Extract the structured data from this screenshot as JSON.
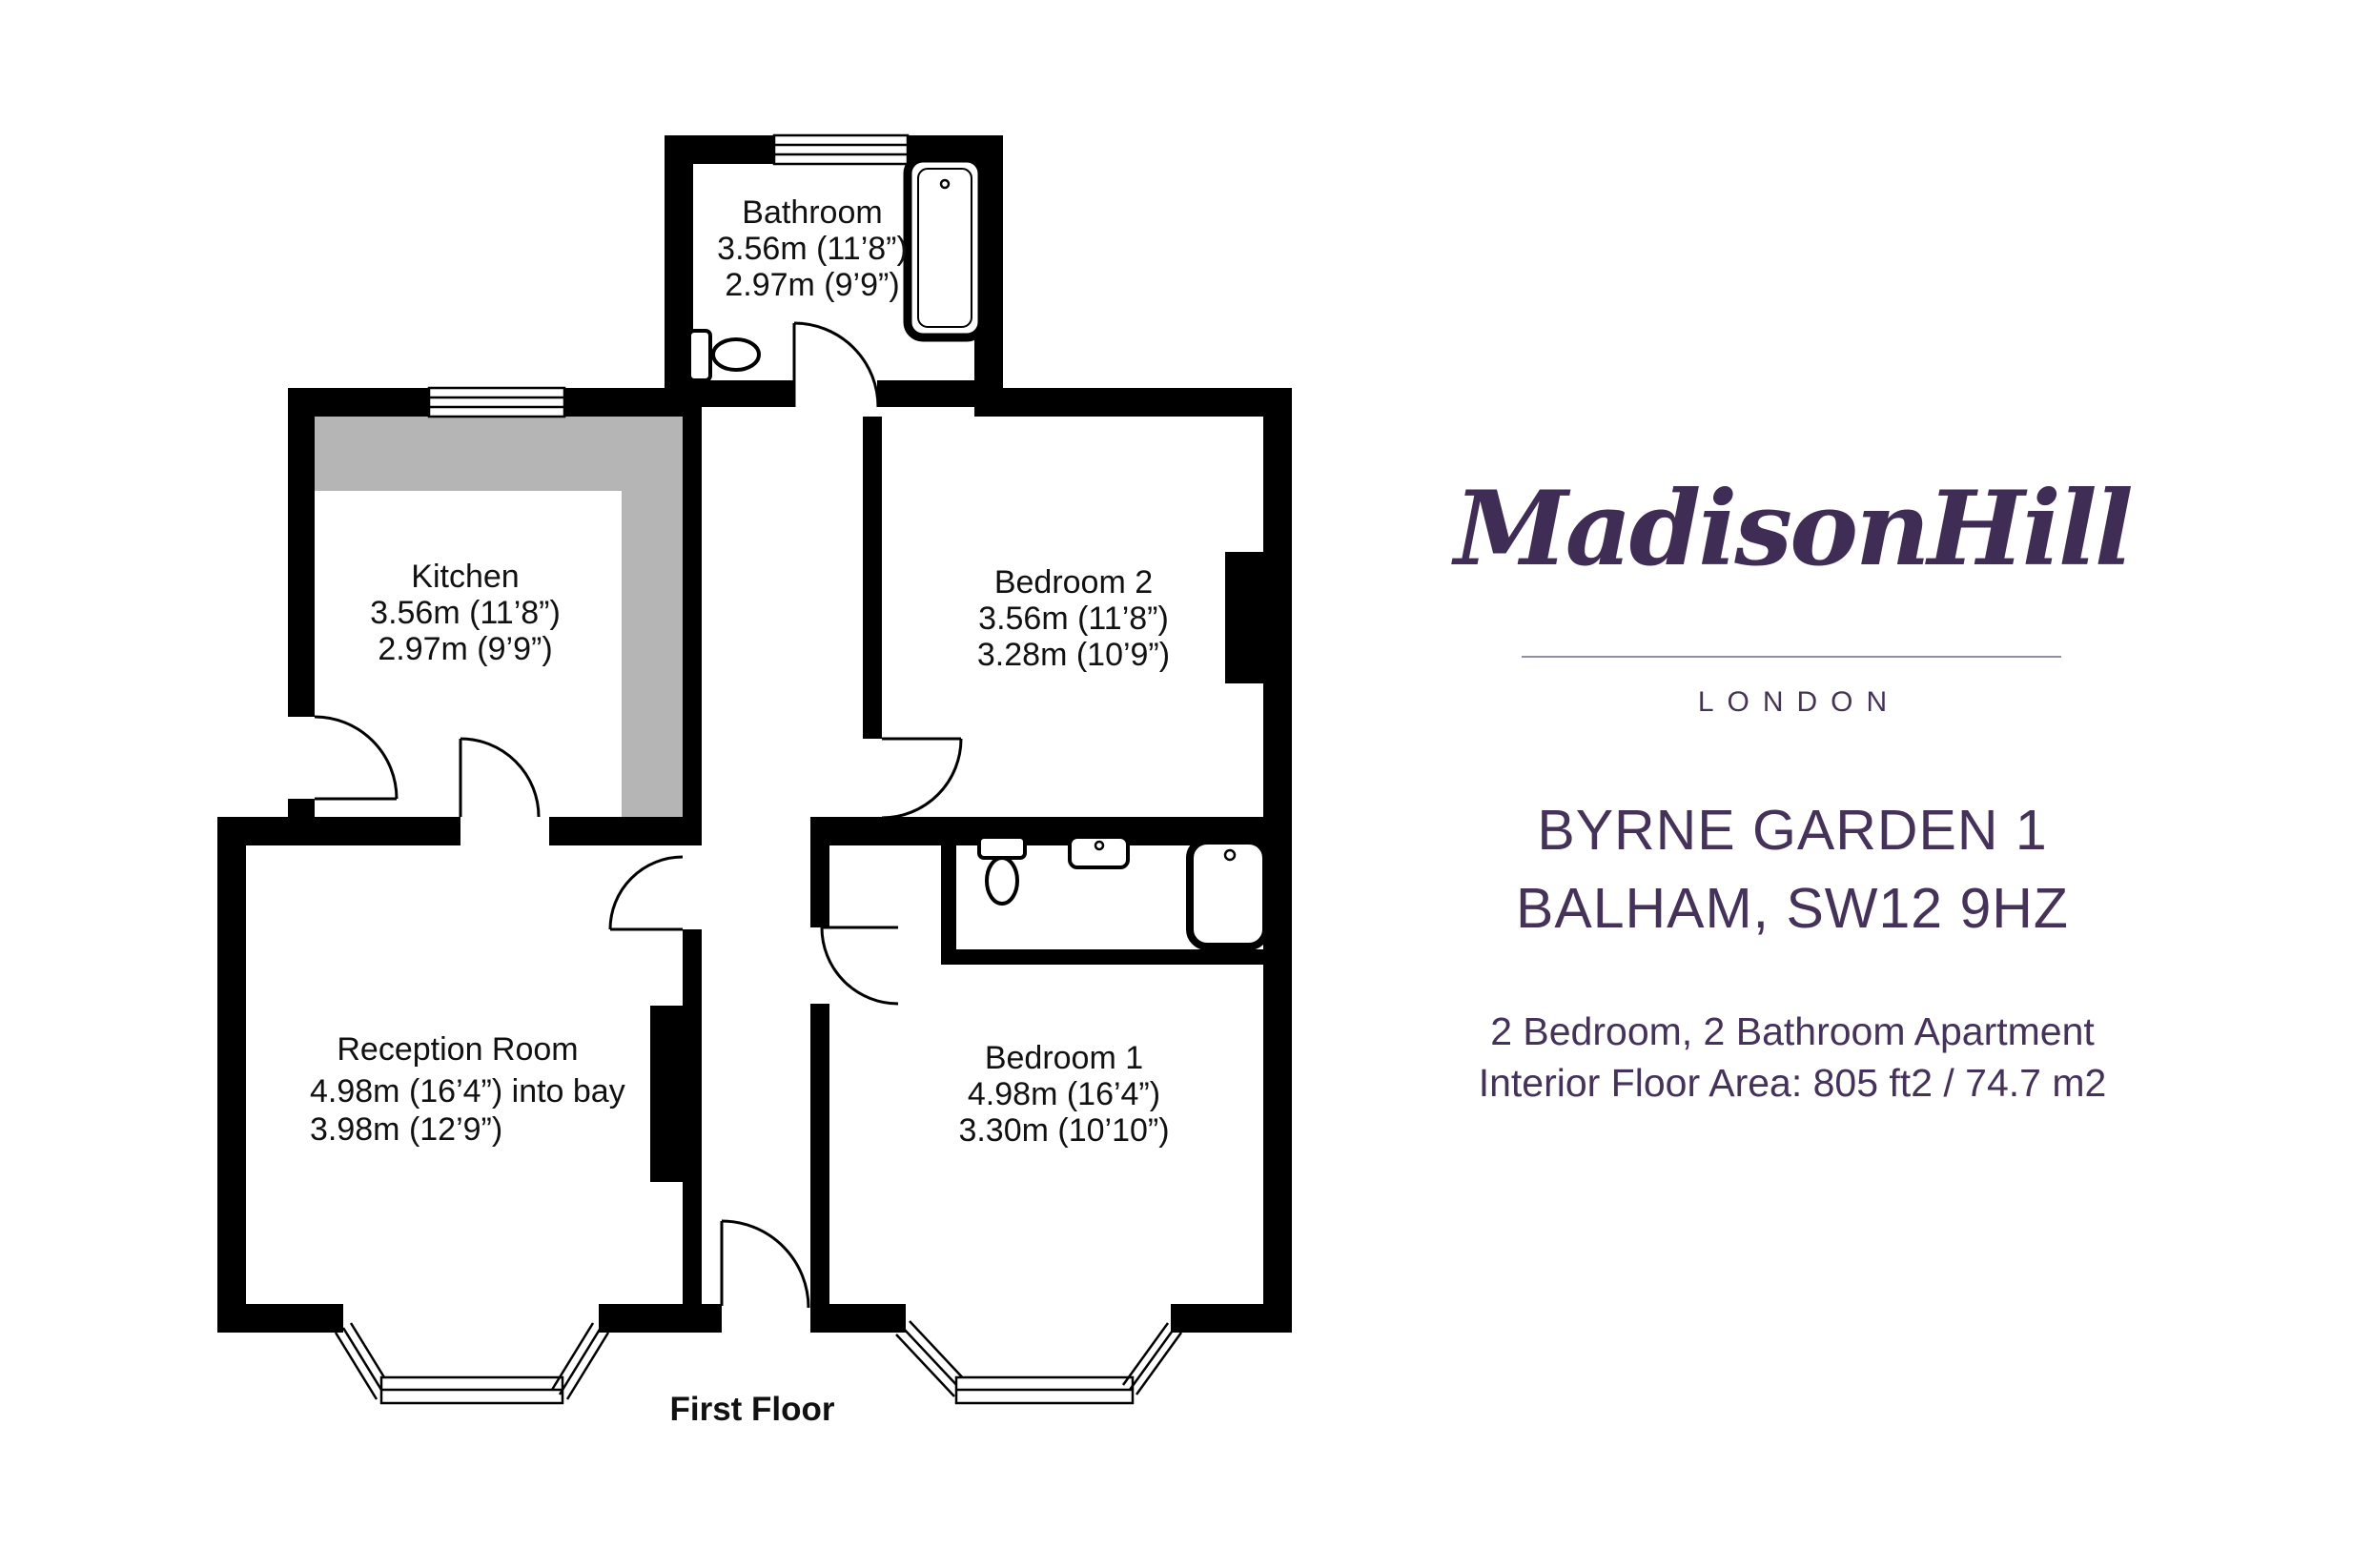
{
  "brand": {
    "logo_text": "MadisonHill",
    "city_label": "LONDON"
  },
  "property": {
    "address_line1": "BYRNE GARDEN 1",
    "address_line2": "BALHAM, SW12 9HZ",
    "summary_line1": "2 Bedroom, 2 Bathroom Apartment",
    "summary_line2": "Interior Floor Area: 805 ft2 / 74.7 m2"
  },
  "floorplan": {
    "floor_label": "First Floor",
    "rooms": [
      {
        "name": "Bathroom",
        "dim1": "3.56m (11’8”)",
        "dim2": "2.97m (9’9”)"
      },
      {
        "name": "Kitchen",
        "dim1": "3.56m (11’8”)",
        "dim2": "2.97m (9’9”)"
      },
      {
        "name": "Bedroom 2",
        "dim1": "3.56m (11’8”)",
        "dim2": "3.28m (10’9”)"
      },
      {
        "name": "Reception Room",
        "dim1": "4.98m (16’4”) into bay",
        "dim2": "3.98m (12’9”)"
      },
      {
        "name": "Bedroom 1",
        "dim1": "4.98m (16’4”)",
        "dim2": "3.30m (10’10”)"
      }
    ]
  },
  "colors": {
    "brand_purple": "#443259",
    "logo_purple": "#3f2d55",
    "divider_gray": "#948ca1",
    "plan_black": "#000000",
    "counter_gray": "#b5b5b5",
    "background": "#ffffff"
  }
}
